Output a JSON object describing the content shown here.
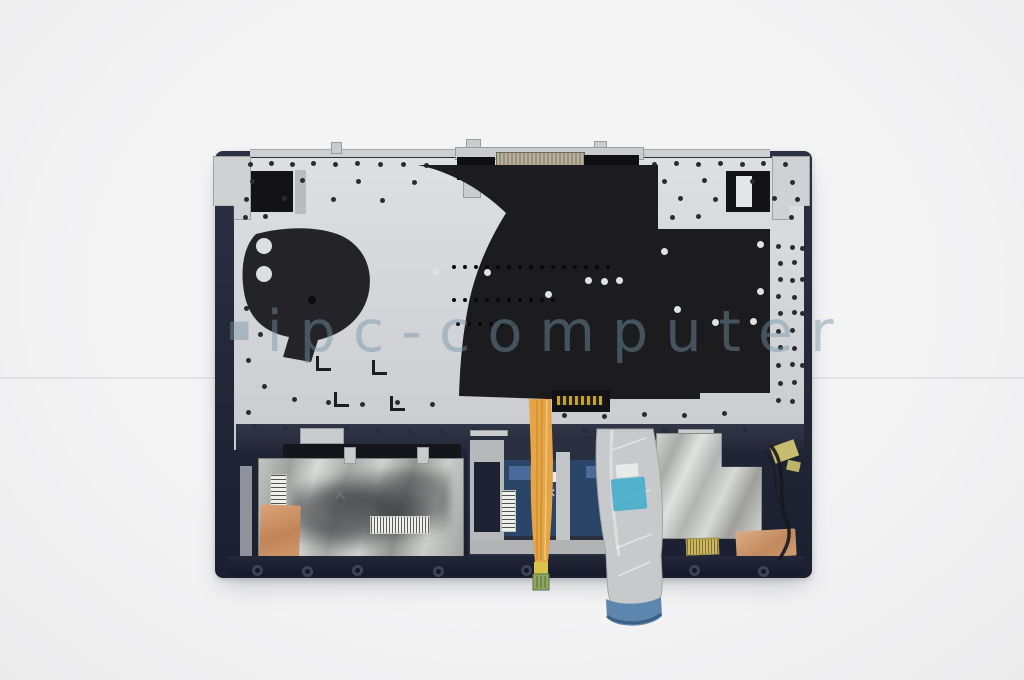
{
  "photo": {
    "subject": "laptop-palmrest-internal-assembly",
    "background_color": "#f1f1f2"
  },
  "watermark": {
    "icon": "square",
    "icon_glyph": "■",
    "text": "ipc-computer",
    "color": "rgba(118,148,167,0.46)"
  },
  "marks": {
    "x_mark": "✕"
  },
  "colors": {
    "frame_navy": "#222838",
    "plate_silver": "#d6d8da",
    "keyboard_shield_black": "#1c1c1f",
    "foil_silver": "#b5b7b5",
    "copper_foil": "#c8926a",
    "touchpad_blue": "#2b4569",
    "ribbon_cable_gray": "#c7c9cb",
    "ribbon_tip_blue": "#5e86ae",
    "backlight_cable_orange": "#e5a546",
    "backlight_tip_green": "#8ea863",
    "kapton_tape_yellow": "#c6bd6e",
    "sticker_cyan": "#45aecb",
    "label_white": "#ebebe8",
    "label_yellow": "#cdb85c"
  }
}
